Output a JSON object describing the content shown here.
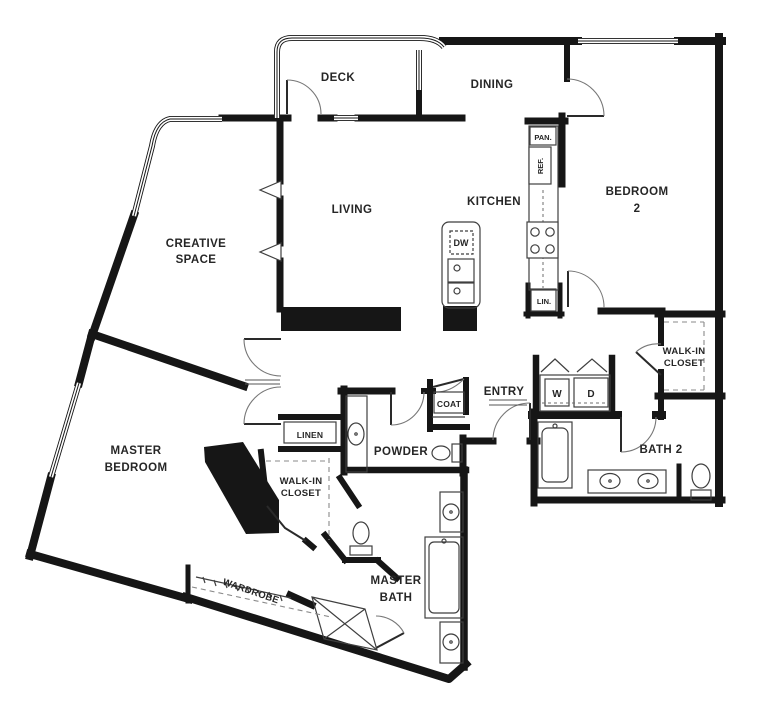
{
  "floorplan": {
    "rooms": {
      "deck": "DECK",
      "dining": "DINING",
      "living": "LIVING",
      "kitchen": "KITCHEN",
      "bedroom2": {
        "line1": "BEDROOM",
        "line2": "2"
      },
      "creative_space": {
        "line1": "CREATIVE",
        "line2": "SPACE"
      },
      "master_bedroom": {
        "line1": "MASTER",
        "line2": "BEDROOM"
      },
      "master_bath": {
        "line1": "MASTER",
        "line2": "BATH"
      },
      "bath2": "BATH 2",
      "powder": "POWDER",
      "entry": "ENTRY",
      "walk_in_closet_bedroom2": {
        "line1": "WALK-IN",
        "line2": "CLOSET"
      },
      "walk_in_closet_master": {
        "line1": "WALK-IN",
        "line2": "CLOSET"
      }
    },
    "fixtures": {
      "pantry": "PAN.",
      "refrigerator": "REF.",
      "linen_kitchen": "LIN.",
      "linen_hall": "LINEN",
      "coat": "COAT",
      "dishwasher": "DW",
      "washer": "W",
      "dryer": "D",
      "wardrobe": "WARDROBE"
    },
    "colors": {
      "walls": "#161616",
      "fixture_lines": "#3f3f3f",
      "background": "#ffffff",
      "labels": "#262626"
    }
  }
}
